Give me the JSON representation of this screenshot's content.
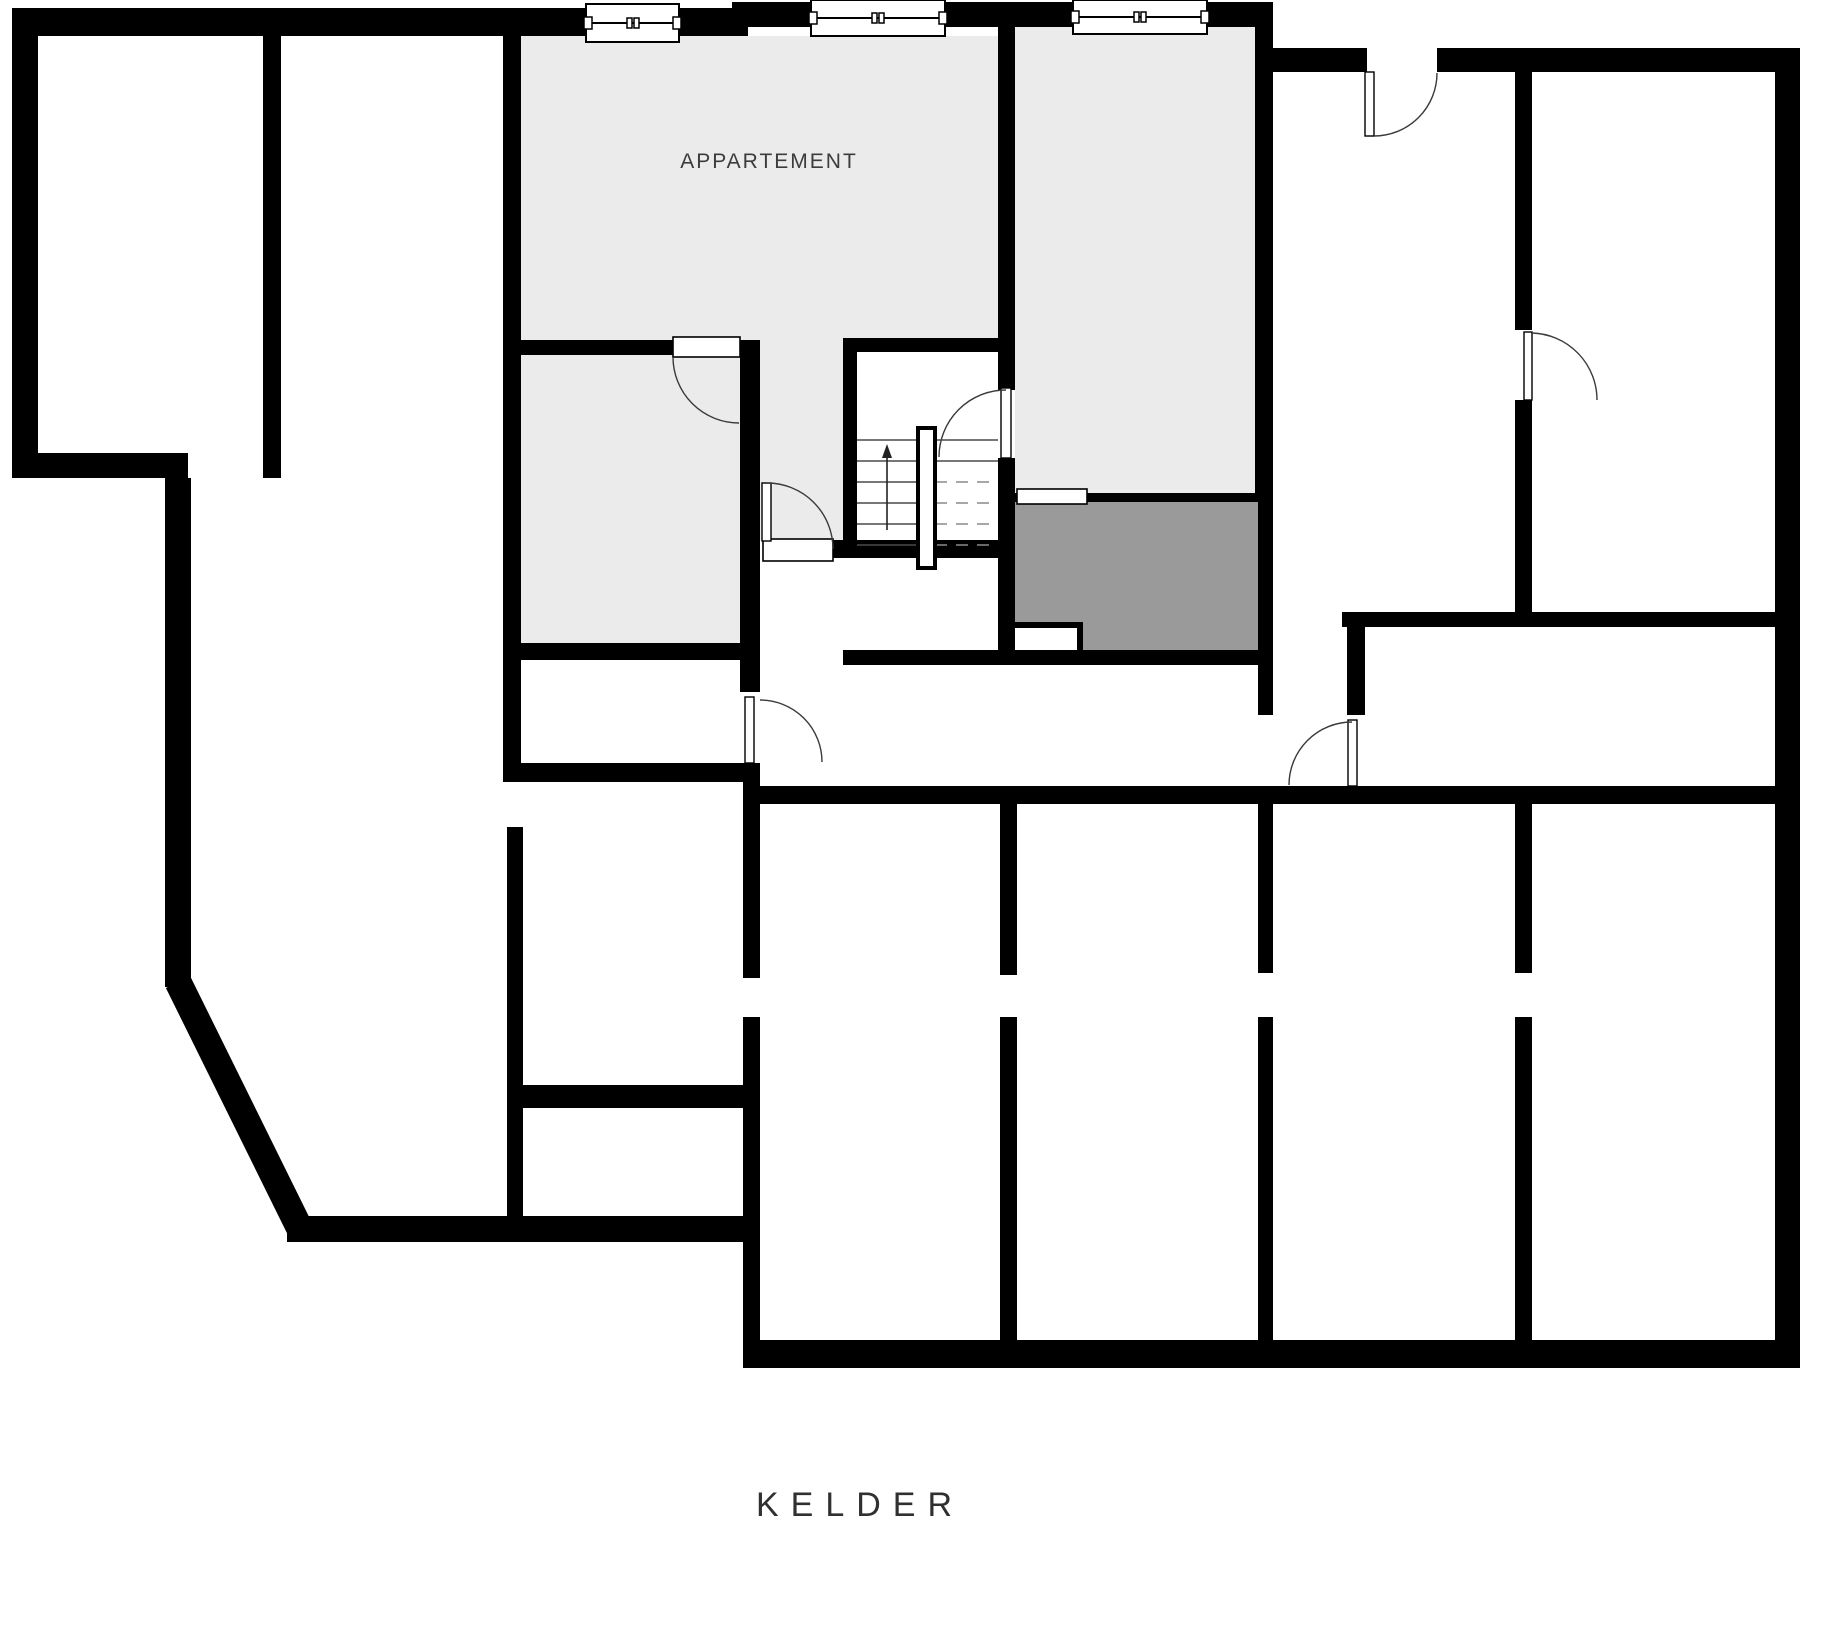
{
  "plan": {
    "labels": {
      "apartment": "APPARTEMENT",
      "floor_title": "KELDER"
    },
    "colors": {
      "background": "#ffffff",
      "wall": "#000000",
      "room_light": "#ebebeb",
      "room_dark": "#9a9a9a",
      "label_text": "#3c3c3c",
      "title_text": "#303030"
    }
  }
}
